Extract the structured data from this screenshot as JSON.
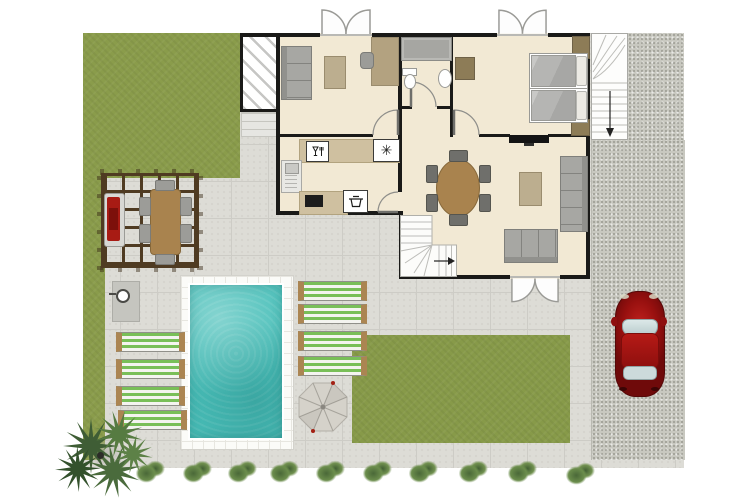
{
  "scene": {
    "kind": "architectural-floor-plan",
    "view": "top-down",
    "description": "Ground floor plan of a holiday villa with pool terrace, pergola dining area, barbecue, lawn, gravel driveway with parked red car, sun loungers and parasol"
  },
  "palette": {
    "grass": "#8a9c4b",
    "lawn": "#879a49",
    "patio": "#dddcd6",
    "patio_line": "#cdccc6",
    "gravel": "#c8c8c0",
    "floor": "#f2e9d4",
    "wall": "#1a1a18",
    "counter_wood": "#cfc0a0",
    "table_wood": "#a9834e",
    "pergola_wood": "#4f3b22",
    "furniture_gray": "#a7a7a3",
    "chair_dark": "#6f6f6b",
    "pool_water": "#49bfb9",
    "pool_deck": "#fbfbf8",
    "lounger_green": "#79bf58",
    "lounger_wood": "#ab8552",
    "car_red": "#9e1111",
    "bush_green": "#587843",
    "palm_green": "#3f5d35",
    "shower_tray": "#a6a6a2",
    "wardrobe_wood": "#8d7c57"
  },
  "glyphs": {
    "freezer": "✳"
  },
  "icons": [
    "dishwasher-icon",
    "freezer-icon",
    "washing-machine-icon",
    "hob-icon",
    "shower-head-icon",
    "stair-arrow-icon",
    "french-doors-icon"
  ],
  "rooms": {
    "lounge_study": {
      "furniture": [
        "sofa",
        "coffee table",
        "desk",
        "desk chair"
      ],
      "doors": [
        "double french doors to front",
        "door to hall"
      ]
    },
    "bathroom": {
      "fixtures": [
        "shower",
        "toilet",
        "washbasin"
      ]
    },
    "bedroom": {
      "furniture": [
        "twin bed",
        "twin bed",
        "wardrobe x3",
        "wall tv"
      ],
      "doors": [
        "double french doors to front",
        "door to hall"
      ]
    },
    "kitchen": {
      "appliances": [
        "dishwasher",
        "freezer",
        "sink unit",
        "hob",
        "washing machine"
      ]
    },
    "living_dining": {
      "furniture": [
        "oval dining table with 6 chairs",
        "sofa",
        "sofa",
        "coffee table"
      ],
      "features": [
        "internal winder staircase",
        "double doors to terrace"
      ]
    },
    "porch": {
      "type": "hatched covered entrance with steps"
    }
  },
  "outdoor": {
    "pool": {
      "shape": "rectangular",
      "surround": "white tiled deck"
    },
    "sun_loungers": {
      "count": 8,
      "style": "green and white striped"
    },
    "parasol": {
      "shape": "octagonal"
    },
    "pergola": {
      "contents": [
        "wooden dining table with 6 chairs",
        "red barbecue"
      ]
    },
    "outdoor_shower": true,
    "exterior_staircase": true,
    "car": {
      "color": "red",
      "location": "gravel driveway"
    },
    "driveway": "gravel",
    "bushes": {
      "count": 10
    },
    "palm_cluster": {
      "count": 1
    }
  }
}
